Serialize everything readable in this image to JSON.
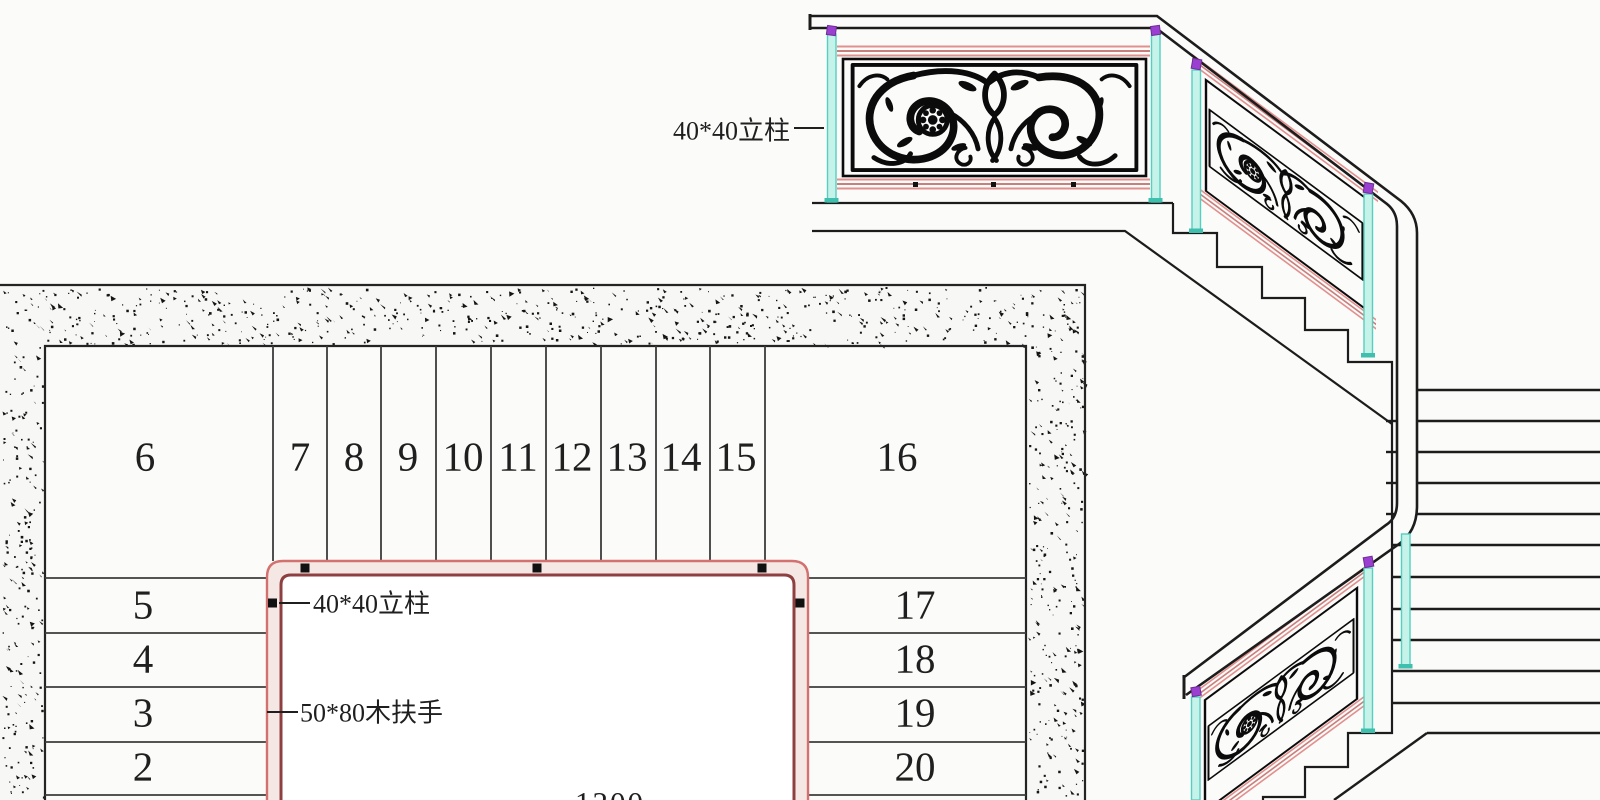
{
  "drawing": {
    "type_label": "staircase plan and railing elevation",
    "plan": {
      "upper_treads": [
        "6",
        "7",
        "8",
        "9",
        "10",
        "11",
        "12",
        "13",
        "14",
        "15",
        "16"
      ],
      "left_treads": [
        "5",
        "4",
        "3",
        "2"
      ],
      "right_treads": [
        "17",
        "18",
        "19",
        "20"
      ],
      "post_label": "40*40立柱",
      "handrail_label": "50*80木扶手",
      "dimension": "1200"
    },
    "elevation": {
      "post_label": "40*40立柱"
    }
  },
  "colors": {
    "paper": "#fbfbfa",
    "ink": "#1c1c1c",
    "speck": "#141414",
    "post_fill": "#c5f2e9",
    "post_edge": "#56cfc0",
    "post_base": "#3fbfae",
    "cap_purple": "#9b3fd1",
    "rail_pink": "#e2908d",
    "rail_pink_dark": "#c97f7c",
    "handrail_red_outer": "#d37070",
    "handrail_red_inner": "#8e4040",
    "handrail_fill": "#f5e8e4"
  }
}
